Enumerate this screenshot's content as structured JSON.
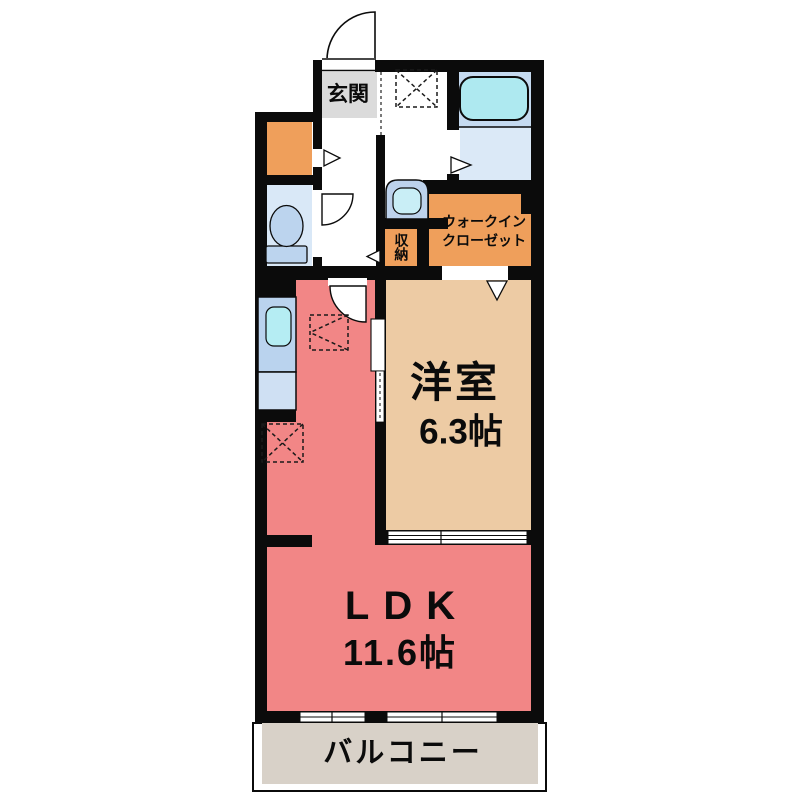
{
  "plan_title": "1LDK apartment floor plan",
  "rooms": {
    "genkan": {
      "label": "玄関"
    },
    "storage": {
      "label": "収納"
    },
    "walk_in_closet": {
      "label_line1": "ウォークイン",
      "label_line2": "クローゼット"
    },
    "western_room": {
      "label": "洋室",
      "size": "6.3帖"
    },
    "ldk": {
      "label": "LDK",
      "size": "11.6帖"
    },
    "balcony": {
      "label": "バルコニー"
    }
  },
  "fixtures": [
    "bathtub",
    "toilet",
    "washbasin",
    "kitchen-sink",
    "kitchen-counter",
    "washing-machine-area",
    "refrigerator-area",
    "entrance-door-swing",
    "toilet-door-swing",
    "ldk-door-swing",
    "sliding-door",
    "windows",
    "door-direction-markers"
  ],
  "colors": {
    "wall": "#0b0b0b",
    "ldk": "#F28686",
    "western_room": "#EDCBA4",
    "closet_orange": "#EF9F5B",
    "genkan_gray": "#DBDBDB",
    "balcony": "#D8D1C8",
    "bath_upper": "#C5DAF0",
    "bath_lower": "#DBE9F7",
    "bathtub": "#AEE9F0",
    "toilet_room": "#D9E8F7",
    "toilet_fixture": "#BCD4EE",
    "washbasin_body": "#BDD2EC",
    "washbasin_bowl": "#C9EEF6",
    "kitchen_counter": "#BAD3EE",
    "kitchen_counter_lower": "#CFE0F3",
    "kitchen_sink": "#B5EDF3",
    "white": "#FFFFFF"
  }
}
